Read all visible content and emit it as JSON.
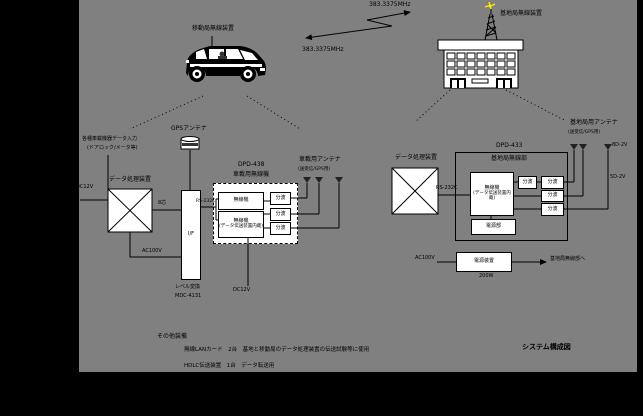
{
  "diagram_title": "システム構成図",
  "radio_link": {
    "freq_up": "383.3375MHz",
    "freq_down": "383.3375MHz"
  },
  "mobile": {
    "station_label": "移動局無線装置",
    "gps_antenna_label": "GPSアンテナ",
    "vehicle_input_line1": "各種車載機器データ入力",
    "vehicle_input_line2": "(ドアロック/メータ等)",
    "dc_input_label": "DC12V",
    "data_processor_label": "データ処理装置",
    "bus_label": "8芯",
    "power_wire_label": "AC100V",
    "interface_label": "I/F",
    "level_converter_label": "レベル変換",
    "model_number": "MDC-4131",
    "rs232c_label": "RS-232C",
    "radio_unit_model": "DPD-438",
    "radio_unit_label": "車載用無線機",
    "radio1_label": "無線機",
    "radio2_label": "無線機",
    "radio2_sublabel": "(データ伝送装置内蔵)",
    "duplexer_labels": [
      "分波",
      "分波",
      "分波"
    ],
    "radio_power_label": "DC12V",
    "antenna_label": "車載用アンテナ",
    "antenna_sublabel": "(送受信/GPS用)"
  },
  "base": {
    "station_label": "基地局無線装置",
    "data_processor_label": "データ処理装置",
    "rs232c_label": "RS-232C",
    "radio_unit_model": "DPD-433",
    "radio_unit_label": "基地局無線部",
    "radio_label": "無線機",
    "radio_sublabel": "(データ伝送装置内蔵)",
    "duplexer_label": "分波",
    "filter_labels": [
      "分波",
      "分波",
      "分波"
    ],
    "psu_inner_label": "電源部",
    "antenna_label": "基地局用アンテナ",
    "antenna_sublabel": "(送受信/GPS用)",
    "coax_label_1": "8D-2V",
    "coax_label_2": "5D-2V",
    "ac_input_label": "AC100V",
    "psu_box_label": "電源装置",
    "psu_output_label": "基地局無線部へ",
    "psu_rating": "200W"
  },
  "notes": {
    "heading": "その他装備",
    "line1": "無線LANカード　2台　基地と移動局のデータ処理装置の伝送試験等に使用",
    "line2": "HDLC伝送装置　1台　データ転送用"
  }
}
